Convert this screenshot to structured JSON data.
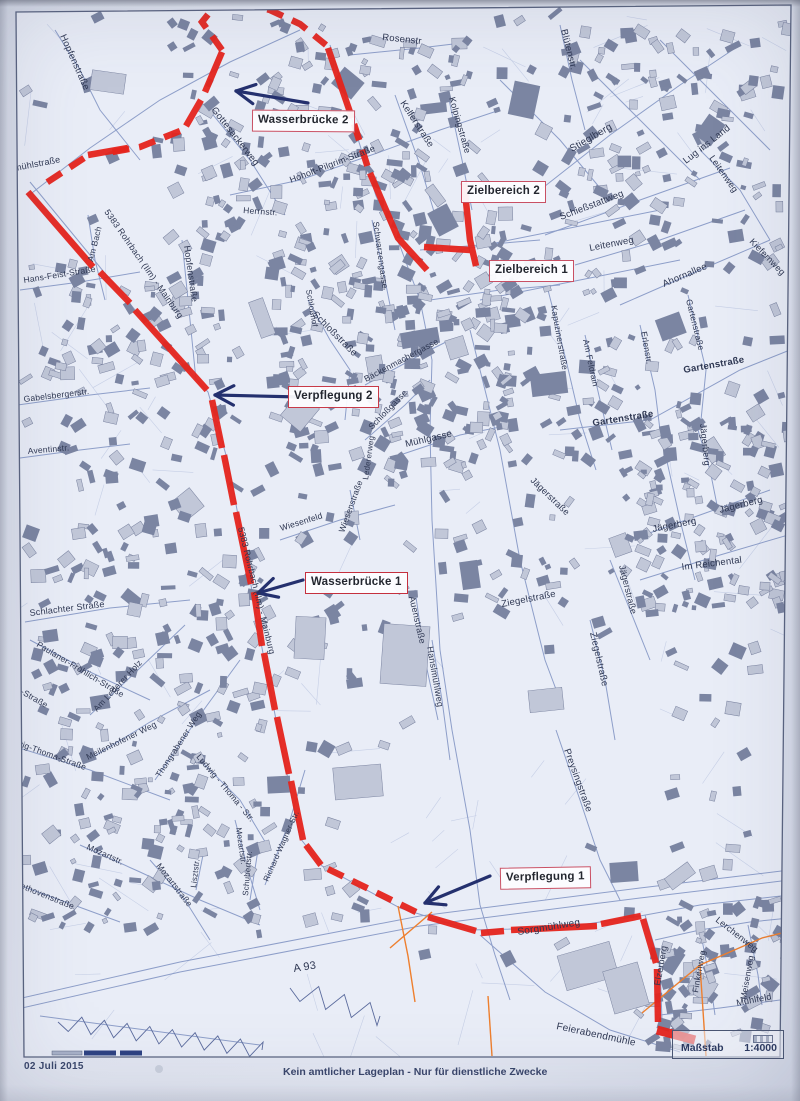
{
  "page": {
    "date": "02 Juli 2015",
    "disclaimer": "Kein amtlicher Lageplan - Nur für dienstliche Zwecke",
    "scale_label": "Maßstab",
    "scale_value": "1:4000"
  },
  "colors": {
    "route_red": "#e5241c",
    "callout_border": "#c95064",
    "arrow_blue": "#24306e",
    "street_line": "#7e91c1",
    "building_dark": "#7b85a2",
    "building_light": "#c1c7d8",
    "boundary_orange": "#ee7f2e",
    "label_text": "#2e3752",
    "paper": "#e2e6f1"
  },
  "callouts": [
    {
      "id": "wasserbruecke-2",
      "label": "Wasserbrücke 2",
      "arrow": {
        "x1": 308,
        "y1": 103,
        "x2": 236,
        "y2": 91
      }
    },
    {
      "id": "zielbereich-2",
      "label": "Zielbereich 2"
    },
    {
      "id": "zielbereich-1",
      "label": "Zielbereich 1"
    },
    {
      "id": "verpflegung-2",
      "label": "Verpflegung 2",
      "arrow": {
        "x1": 300,
        "y1": 397,
        "x2": 215,
        "y2": 395
      }
    },
    {
      "id": "wasserbruecke-1",
      "label": "Wasserbrücke 1",
      "arrow": {
        "x1": 303,
        "y1": 580,
        "x2": 258,
        "y2": 593
      }
    },
    {
      "id": "verpflegung-1",
      "label": "Verpflegung 1",
      "arrow": {
        "x1": 490,
        "y1": 876,
        "x2": 425,
        "y2": 903
      }
    }
  ],
  "street_labels": [
    {
      "t": "Hopfenstraße",
      "x": 60,
      "y": 36,
      "r": 66,
      "s": 9.5
    },
    {
      "t": "Hopfenstraße",
      "x": 184,
      "y": 246,
      "r": 82,
      "s": 9
    },
    {
      "t": "Rosenstr",
      "x": 382,
      "y": 40,
      "r": 6,
      "s": 9.5
    },
    {
      "t": "Blütenstr.",
      "x": 561,
      "y": 30,
      "r": 76,
      "s": 9.5
    },
    {
      "t": "Stieglberg",
      "x": 572,
      "y": 152,
      "r": -30,
      "s": 10
    },
    {
      "t": "Lug ins Land",
      "x": 686,
      "y": 164,
      "r": -38,
      "s": 9.5
    },
    {
      "t": "Leitenweg",
      "x": 590,
      "y": 251,
      "r": -11,
      "s": 9.5
    },
    {
      "t": "Leitenweg",
      "x": 709,
      "y": 158,
      "r": 55,
      "s": 9
    },
    {
      "t": "Schießstattweg",
      "x": 561,
      "y": 220,
      "r": -21,
      "s": 9.5
    },
    {
      "t": "Kellerstraße",
      "x": 400,
      "y": 103,
      "r": 57,
      "s": 9.5
    },
    {
      "t": "Kolpingstraße",
      "x": 449,
      "y": 98,
      "r": 74,
      "s": 9
    },
    {
      "t": "Hoholt-Pilgrim-Straße",
      "x": 291,
      "y": 183,
      "r": -21,
      "s": 9
    },
    {
      "t": "Gottesackerweg",
      "x": 211,
      "y": 110,
      "r": 52,
      "s": 9.5
    },
    {
      "t": "Herrnstr.",
      "x": 243,
      "y": 213,
      "r": 4,
      "s": 8.5
    },
    {
      "t": "Schwarzengasse",
      "x": 373,
      "y": 222,
      "r": 82,
      "s": 8.5
    },
    {
      "t": "smühlstraße",
      "x": 10,
      "y": 172,
      "r": -11,
      "s": 9
    },
    {
      "t": "Am Bach",
      "x": 93,
      "y": 262,
      "r": -76,
      "s": 8.5
    },
    {
      "t": "5383 Rohrbach (Ilm) - Mainburg",
      "x": 104,
      "y": 212,
      "r": 55,
      "s": 8.8
    },
    {
      "t": "5383 Rohrbach (Ilm) - Mainburg",
      "x": 238,
      "y": 528,
      "r": 76,
      "s": 8.8
    },
    {
      "t": "Hans-Feist-Straße",
      "x": 24,
      "y": 283,
      "r": -9,
      "s": 8.5
    },
    {
      "t": "Gabelsbergerstr.",
      "x": 24,
      "y": 402,
      "r": -7,
      "s": 8.5
    },
    {
      "t": "Aventinstr.",
      "x": 28,
      "y": 454,
      "r": -5,
      "s": 8.5
    },
    {
      "t": "Schloßstraße",
      "x": 312,
      "y": 315,
      "r": 45,
      "s": 9.5
    },
    {
      "t": "Schloßhof",
      "x": 306,
      "y": 290,
      "r": 80,
      "s": 8
    },
    {
      "t": "Bäckenmachergasse",
      "x": 366,
      "y": 382,
      "r": -28,
      "s": 8.5
    },
    {
      "t": "Schloßgasse",
      "x": 372,
      "y": 430,
      "r": -46,
      "s": 8.5
    },
    {
      "t": "Ledererweg",
      "x": 368,
      "y": 480,
      "r": -82,
      "s": 8
    },
    {
      "t": "Mühlgasse",
      "x": 406,
      "y": 447,
      "r": -13,
      "s": 9.5
    },
    {
      "t": "Kapuzinerstraße",
      "x": 551,
      "y": 306,
      "r": 80,
      "s": 8.5
    },
    {
      "t": "Am Feldrain",
      "x": 583,
      "y": 340,
      "r": 78,
      "s": 8.5
    },
    {
      "t": "Erlenstr.",
      "x": 641,
      "y": 332,
      "r": 80,
      "s": 8.5
    },
    {
      "t": "Gartenstraße",
      "x": 686,
      "y": 300,
      "r": 76,
      "s": 8.5
    },
    {
      "t": "Gartenstraße",
      "x": 684,
      "y": 373,
      "r": -10,
      "s": 9.5,
      "b": 1
    },
    {
      "t": "Gartenstraße",
      "x": 593,
      "y": 426,
      "r": -9,
      "s": 9.5,
      "b": 1
    },
    {
      "t": "Ahornallee",
      "x": 664,
      "y": 287,
      "r": -23,
      "s": 9.5
    },
    {
      "t": "Kiefernweg",
      "x": 749,
      "y": 242,
      "r": 46,
      "s": 9
    },
    {
      "t": "Jägerberg",
      "x": 700,
      "y": 424,
      "r": 84,
      "s": 9
    },
    {
      "t": "Jägerberg",
      "x": 720,
      "y": 513,
      "r": -14,
      "s": 9.5
    },
    {
      "t": "Jägerberg",
      "x": 653,
      "y": 532,
      "r": -11,
      "s": 9.5
    },
    {
      "t": "Im Reichental",
      "x": 682,
      "y": 570,
      "r": -7,
      "s": 9.5
    },
    {
      "t": "Jägerstraße",
      "x": 619,
      "y": 566,
      "r": 76,
      "s": 9
    },
    {
      "t": "Jägerstraße",
      "x": 530,
      "y": 481,
      "r": 44,
      "s": 9
    },
    {
      "t": "Ziegelstraße",
      "x": 502,
      "y": 607,
      "r": -11,
      "s": 9.5
    },
    {
      "t": "Ziegelstraße",
      "x": 590,
      "y": 633,
      "r": 77,
      "s": 9.5
    },
    {
      "t": "Auenstraße",
      "x": 409,
      "y": 597,
      "r": 77,
      "s": 9
    },
    {
      "t": "Hanslmühlweg",
      "x": 427,
      "y": 647,
      "r": 80,
      "s": 9
    },
    {
      "t": "Wiesenfeld",
      "x": 281,
      "y": 531,
      "r": -17,
      "s": 8.5
    },
    {
      "t": "Wiesenstraße",
      "x": 344,
      "y": 533,
      "r": -70,
      "s": 8.5
    },
    {
      "t": "Schlachter Straße",
      "x": 30,
      "y": 616,
      "r": -7,
      "s": 9
    },
    {
      "t": "Paulaner-Fröhlich-Straße",
      "x": 36,
      "y": 646,
      "r": 31,
      "s": 8.5
    },
    {
      "t": "hlich-Straße",
      "x": 4,
      "y": 684,
      "r": 30,
      "s": 8.5
    },
    {
      "t": "Am Lederer Holz",
      "x": 97,
      "y": 712,
      "r": -47,
      "s": 8.5
    },
    {
      "t": "Ludwig-Thoma-Straße",
      "x": 2,
      "y": 740,
      "r": 20,
      "s": 8.5
    },
    {
      "t": "Ludwig - Thoma - Str.",
      "x": 196,
      "y": 757,
      "r": 50,
      "s": 8.5
    },
    {
      "t": "Thongrabener Weg",
      "x": 160,
      "y": 778,
      "r": -57,
      "s": 8.5
    },
    {
      "t": "Meilenhofener Weg",
      "x": 88,
      "y": 760,
      "r": -26,
      "s": 8.5
    },
    {
      "t": "Mozartstr.",
      "x": 86,
      "y": 849,
      "r": 24,
      "s": 8.5
    },
    {
      "t": "Mozartstraße",
      "x": 156,
      "y": 866,
      "r": 52,
      "s": 8.5
    },
    {
      "t": "Mozartstr.",
      "x": 236,
      "y": 828,
      "r": 82,
      "s": 8
    },
    {
      "t": "Lisztstr.",
      "x": 196,
      "y": 888,
      "r": -83,
      "s": 8
    },
    {
      "t": "Schubertstr.",
      "x": 248,
      "y": 896,
      "r": -85,
      "s": 8
    },
    {
      "t": "Richard-Wagner-Str.",
      "x": 268,
      "y": 882,
      "r": -66,
      "s": 8
    },
    {
      "t": "Beethovenstraße",
      "x": 10,
      "y": 884,
      "r": 22,
      "s": 8.5
    },
    {
      "t": "A 93",
      "x": 294,
      "y": 972,
      "r": -9,
      "s": 11
    },
    {
      "t": "Sorgmühlweg",
      "x": 518,
      "y": 935,
      "r": -9,
      "s": 10
    },
    {
      "t": "Feierabendmühle",
      "x": 556,
      "y": 1029,
      "r": 12,
      "s": 10
    },
    {
      "t": "Elzerberg",
      "x": 660,
      "y": 986,
      "r": -80,
      "s": 9
    },
    {
      "t": "Lerchenweg",
      "x": 715,
      "y": 921,
      "r": 38,
      "s": 9
    },
    {
      "t": "Finkenweg",
      "x": 698,
      "y": 993,
      "r": -80,
      "s": 8.5
    },
    {
      "t": "Meisenweg",
      "x": 746,
      "y": 1000,
      "r": -80,
      "s": 8.5
    },
    {
      "t": "Mühlfeld",
      "x": 737,
      "y": 1006,
      "r": -11,
      "s": 9
    },
    {
      "t": "Preysingstraße",
      "x": 564,
      "y": 750,
      "r": 70,
      "s": 9.5
    }
  ],
  "route": {
    "color": "#e5241c",
    "width": 6.5,
    "dash": "17 10",
    "segments": [
      {
        "d": 1,
        "p": [
          [
            222,
            50
          ],
          [
            202,
            22
          ],
          [
            214,
            7
          ],
          [
            242,
            3
          ],
          [
            270,
            10
          ],
          [
            300,
            24
          ],
          [
            326,
            45
          ]
        ]
      },
      {
        "d": 0,
        "p": [
          [
            222,
            52
          ],
          [
            205,
            92
          ]
        ]
      },
      {
        "d": 0,
        "p": [
          [
            201,
            100
          ],
          [
            186,
            126
          ]
        ]
      },
      {
        "d": 1,
        "p": [
          [
            180,
            131
          ],
          [
            140,
            147
          ],
          [
            112,
            152
          ]
        ]
      },
      {
        "d": 0,
        "p": [
          [
            128,
            148
          ],
          [
            88,
            155
          ]
        ]
      },
      {
        "d": 1,
        "p": [
          [
            84,
            158
          ],
          [
            40,
            187
          ]
        ]
      },
      {
        "d": 0,
        "p": [
          [
            28,
            192
          ],
          [
            93,
            267
          ]
        ]
      },
      {
        "d": 0,
        "p": [
          [
            100,
            272
          ],
          [
            130,
            303
          ]
        ]
      },
      {
        "d": 0,
        "p": [
          [
            135,
            310
          ],
          [
            207,
            390
          ]
        ]
      },
      {
        "d": 0,
        "p": [
          [
            328,
            48
          ],
          [
            352,
            118
          ]
        ]
      },
      {
        "d": 1,
        "p": [
          [
            354,
            124
          ],
          [
            368,
            168
          ]
        ]
      },
      {
        "d": 0,
        "p": [
          [
            370,
            173
          ],
          [
            398,
            238
          ],
          [
            427,
            270
          ]
        ]
      },
      {
        "d": 0,
        "p": [
          [
            424,
            247
          ],
          [
            470,
            250
          ]
        ]
      },
      {
        "d": 0,
        "p": [
          [
            464,
            183
          ],
          [
            470,
            240
          ],
          [
            476,
            266
          ]
        ]
      },
      {
        "d": 0,
        "p": [
          [
            212,
            400
          ],
          [
            222,
            448
          ]
        ]
      },
      {
        "d": 0,
        "p": [
          [
            224,
            455
          ],
          [
            234,
            505
          ]
        ]
      },
      {
        "d": 0,
        "p": [
          [
            236,
            512
          ],
          [
            251,
            584
          ]
        ]
      },
      {
        "d": 0,
        "p": [
          [
            254,
            592
          ],
          [
            262,
            646
          ]
        ]
      },
      {
        "d": 0,
        "p": [
          [
            264,
            653
          ],
          [
            275,
            710
          ]
        ]
      },
      {
        "d": 0,
        "p": [
          [
            277,
            717
          ],
          [
            289,
            774
          ]
        ]
      },
      {
        "d": 0,
        "p": [
          [
            291,
            781
          ],
          [
            303,
            840
          ]
        ]
      },
      {
        "d": 0,
        "p": [
          [
            306,
            845
          ],
          [
            321,
            865
          ]
        ]
      },
      {
        "d": 1,
        "p": [
          [
            328,
            869
          ],
          [
            420,
            914
          ]
        ]
      },
      {
        "d": 0,
        "p": [
          [
            428,
            917
          ],
          [
            476,
            931
          ]
        ]
      },
      {
        "d": 0,
        "p": [
          [
            481,
            933
          ],
          [
            504,
            931
          ]
        ]
      },
      {
        "d": 0,
        "p": [
          [
            511,
            930
          ],
          [
            597,
            926
          ]
        ]
      },
      {
        "d": 0,
        "p": [
          [
            601,
            924
          ],
          [
            641,
            916
          ]
        ]
      },
      {
        "d": 0,
        "p": [
          [
            643,
            919
          ],
          [
            656,
            963
          ]
        ]
      },
      {
        "d": 0,
        "p": [
          [
            657,
            969
          ],
          [
            658,
            1022
          ]
        ]
      },
      {
        "d": 0,
        "w": 9,
        "p": [
          [
            657,
            1030
          ],
          [
            695,
            1040
          ]
        ]
      }
    ]
  }
}
